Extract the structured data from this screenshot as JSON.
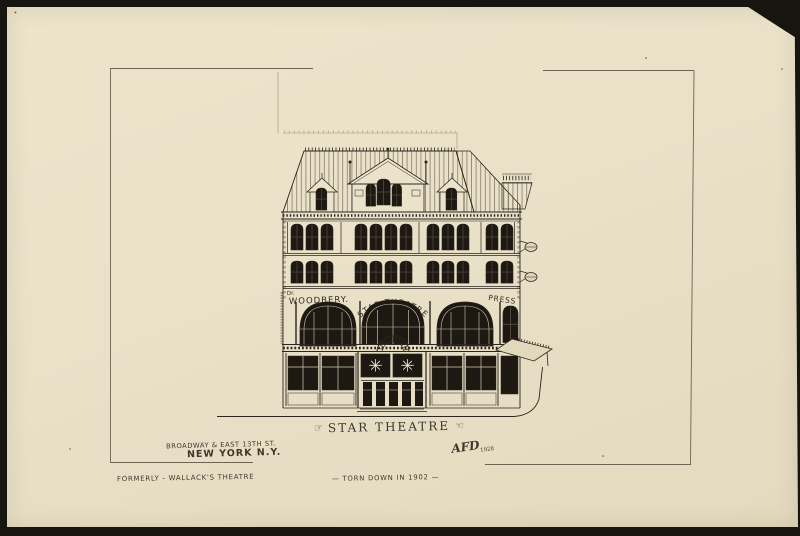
{
  "scan": {
    "mount_color": "#17150f",
    "paper_color": "#e9e1c8",
    "ink_color": "#2b251d"
  },
  "captions": {
    "title": "STAR THEATRE",
    "address_line1": "BROADWAY & EAST 13TH ST.",
    "address_line2": "NEW YORK N.Y.",
    "formerly": "FORMERLY - WALLACK'S THEATRE",
    "torn_down": "— TORN DOWN IN 1902 —",
    "signature_initials": "AFD",
    "signature_year": "1928"
  },
  "building_signs": {
    "doctor_prefix": "Dr.",
    "woodbery": "WOODBERY.",
    "star_theatre": "STAR-THEATRE",
    "press": "PRESS"
  },
  "ornaments": {
    "pointing_hand_left": "☞",
    "pointing_hand_right": "☜",
    "star_panel_icon": "✳"
  }
}
